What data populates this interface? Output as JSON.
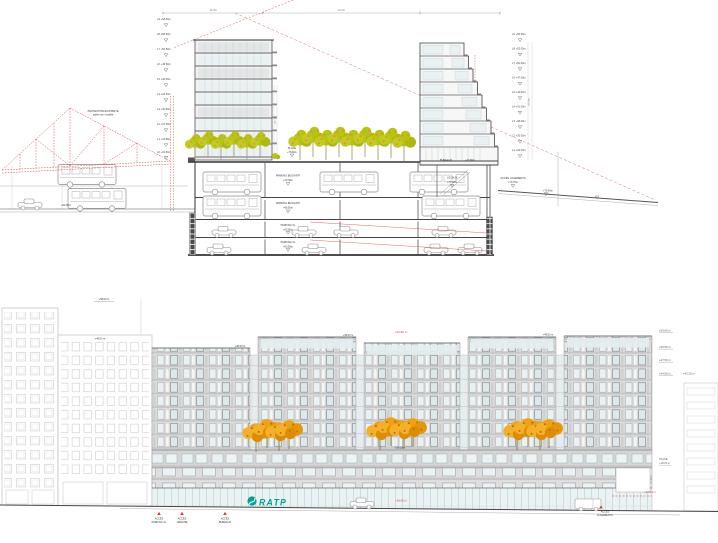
{
  "drawing": {
    "section": {
      "dim_top_left": "11.80",
      "dim_top_right": "14.20",
      "dim_vert_right": "27.85",
      "dim_vert_mid": "21.10",
      "truss_label_1": "PROTECTION EXISTANTE",
      "truss_label_2": "atelier non modifié",
      "depot_tag": "+62.00m",
      "left_levels": [
        "L9 +58.50m",
        "L8 +55.50m",
        "L7 +52.50m",
        "L6 +49.50m",
        "L5 +46.50m",
        "L4 +43.50m",
        "L3 +40.50m",
        "L2 +37.50m",
        "L1 +34.50m",
        "L0 +31.50m"
      ],
      "right_levels": [
        "L9 +56.00m",
        "L8 +53.00m",
        "L7 +50.00m",
        "L6 +47.00m",
        "L5 +44.00m",
        "L4 +41.00m",
        "L3 +38.00m",
        "L2 +35.00m",
        "L1 +32.00m"
      ],
      "place": {
        "name": "PLACE",
        "level": "+76.30m"
      },
      "parking": [
        {
          "name": "PARKING BUS RATP",
          "level": "+70.30m"
        },
        {
          "name": "PARKING BUS RATP",
          "level": "+66.50m"
        },
        {
          "name": "PARKING VL",
          "level": "+63.50m"
        },
        {
          "name": "PARKING VL",
          "level": "+60.50m"
        }
      ],
      "bureaux": {
        "name": "BUREAUX",
        "level": "+73.80m"
      },
      "locaux": {
        "name": "LOCAUX",
        "level": "+70.30m"
      },
      "acces_logements": {
        "name": "ACCÈS LOGEMENTS",
        "level": "+73.70m"
      },
      "right_tag": "+73.40m"
    },
    "elevation": {
      "top_left_tag": "+58.00 m",
      "bld2_tag": "+49.50 m",
      "parapet_tags": [
        "+46.50 m",
        "+49.50 m",
        "+49.50 m"
      ],
      "red_top": "+52.80 m",
      "right_levels": [
        "+53.00 m",
        "+50.50 m",
        "+47.50 m",
        "+44.50 m"
      ],
      "right_level_offset": "+42.20 m",
      "place": {
        "line1": "PLACE",
        "line2": "+19.70 m"
      },
      "tree_tag": "+28.00 m",
      "red_street_center": "+16.00 m",
      "red_street_right": "+16.00 m",
      "ratp": "RATP",
      "access": [
        {
          "l1": "ACCÈS",
          "l2": "PARKING VL"
        },
        {
          "l1": "ACCÈS",
          "l2": "CRÈCHE"
        },
        {
          "l1": "ACCÈS",
          "l2": "BUREAUX"
        },
        {
          "l1": "ACCÈS",
          "l2": "LOGEMENTS"
        }
      ]
    },
    "colors": {
      "red": "#d23c3c",
      "tree_green": "#b5c513",
      "tree_orange": "#f2a210",
      "ratp_teal": "#00a596",
      "facade_gray": "#dcdcdc"
    }
  }
}
